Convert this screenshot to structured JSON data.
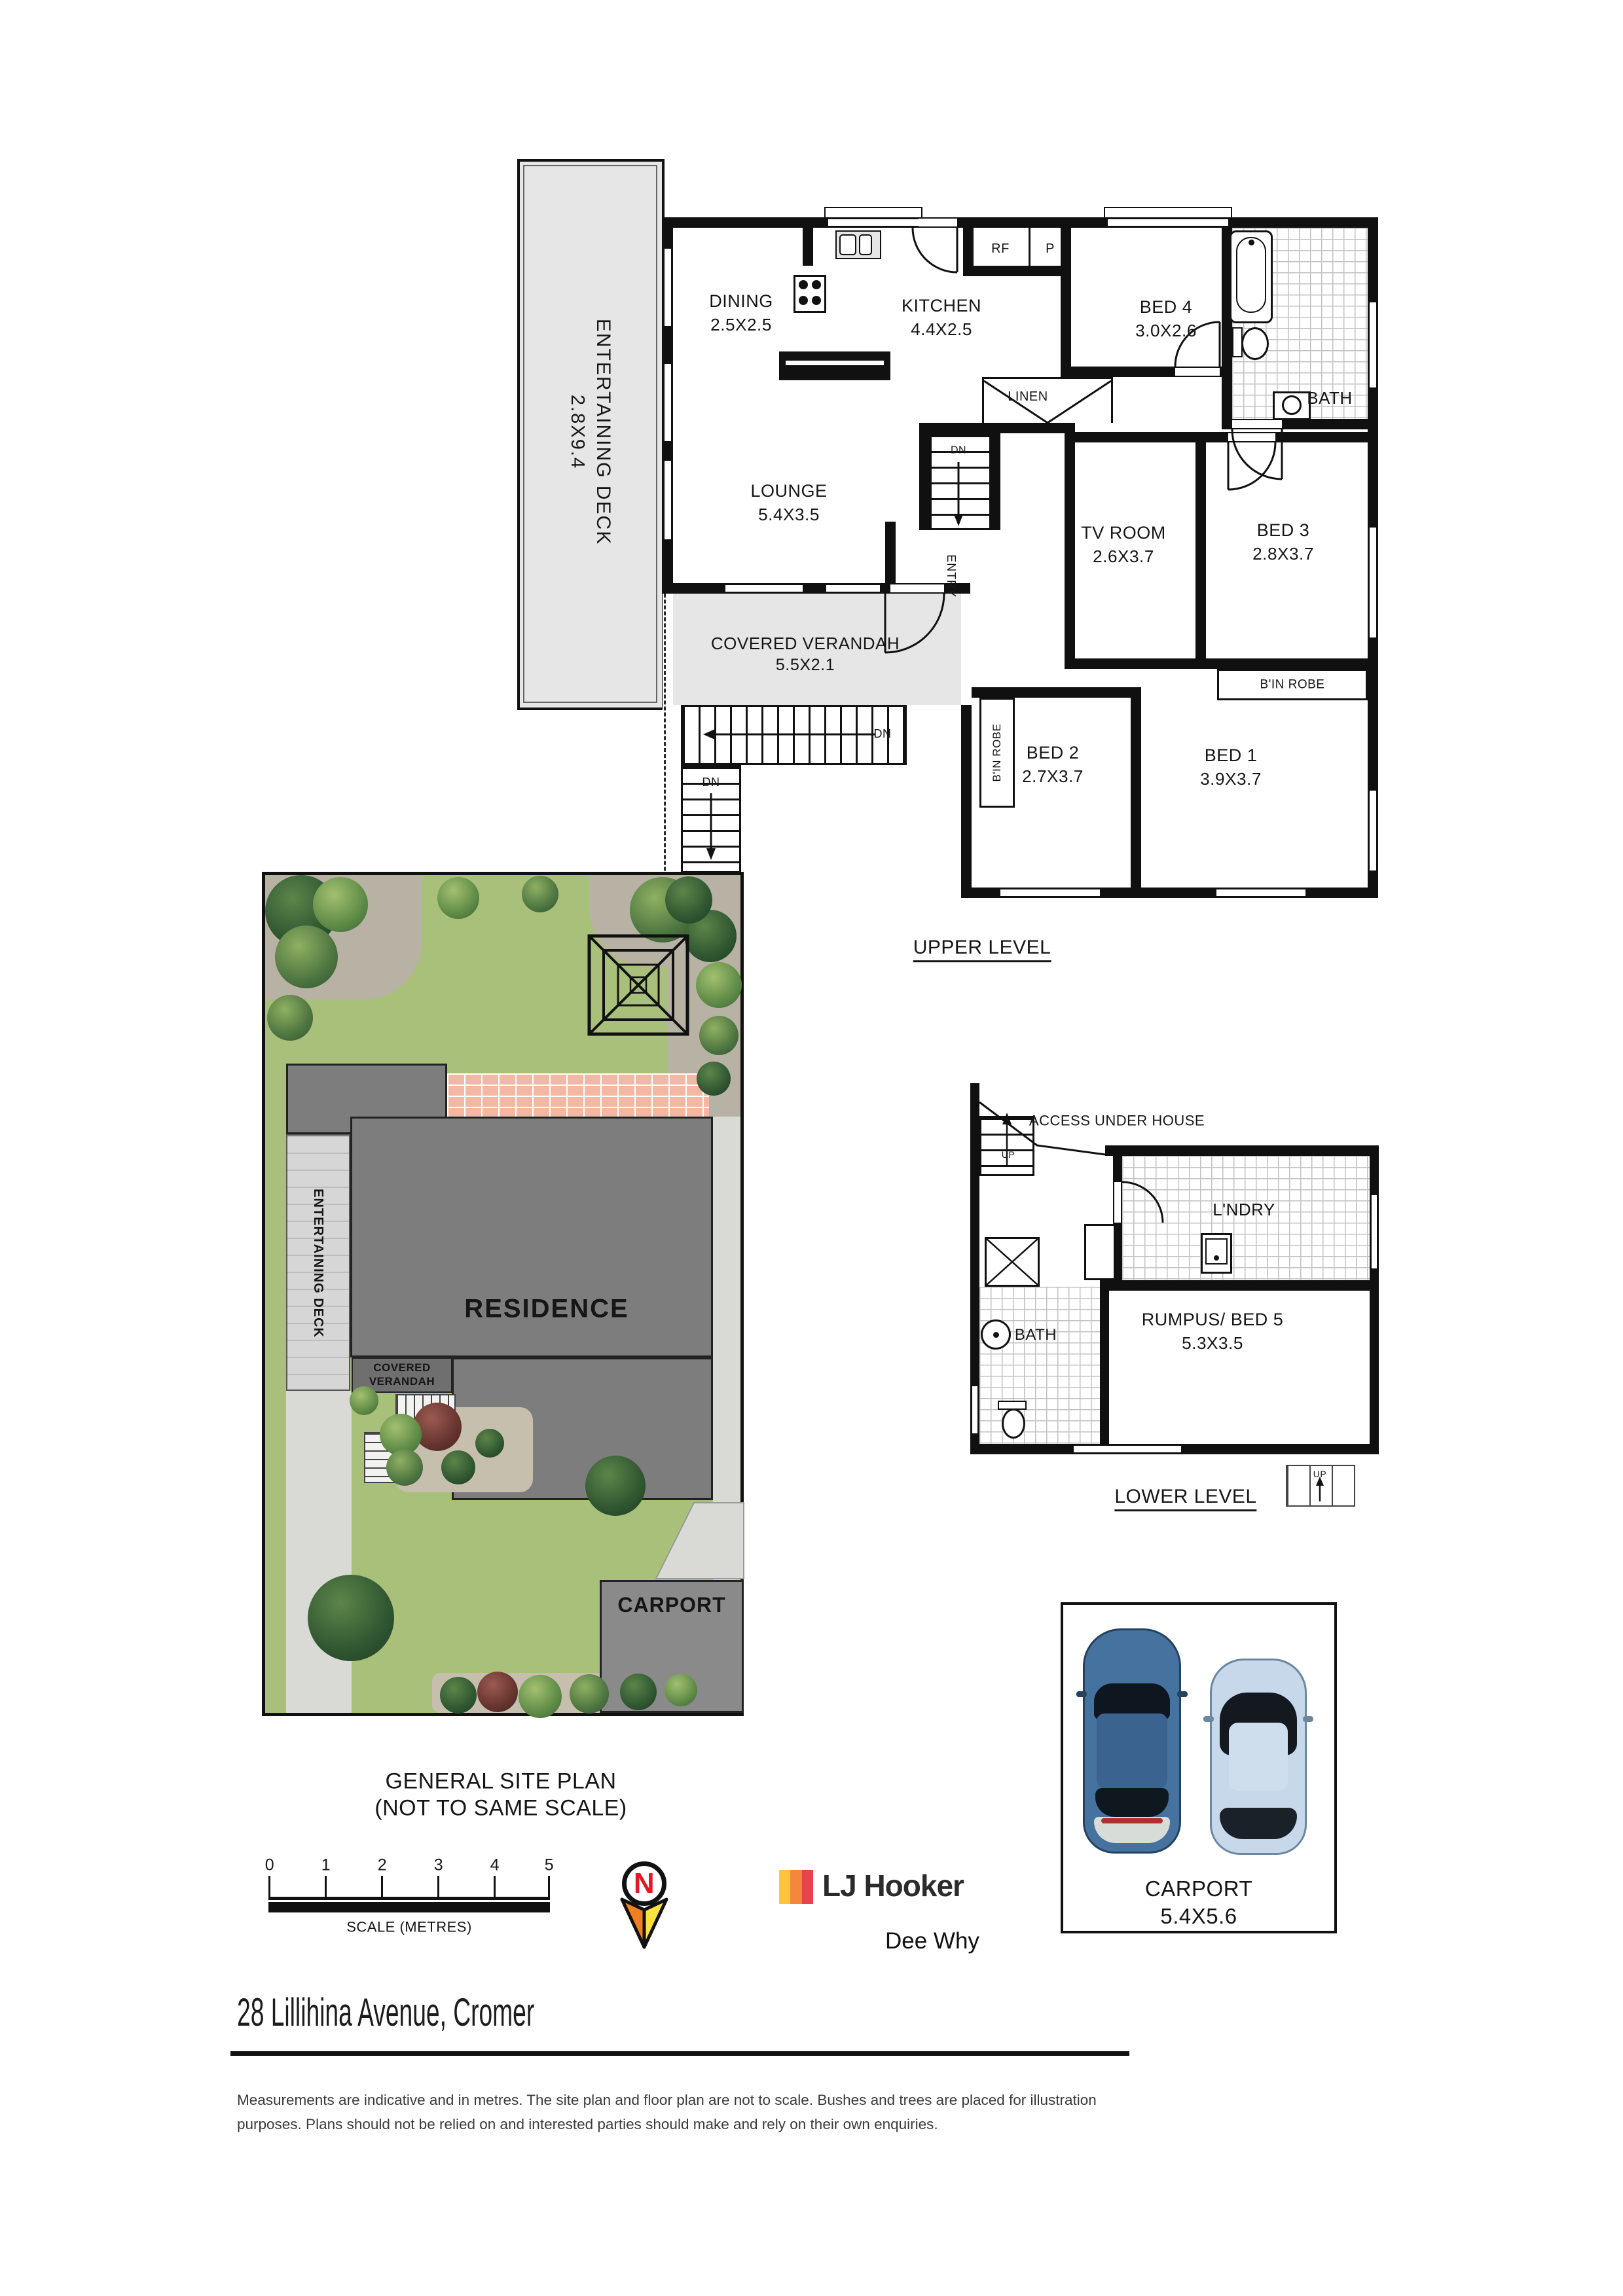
{
  "upper": {
    "title": "UPPER LEVEL",
    "deck": {
      "name": "ENTERTAINING DECK",
      "size": "2.8X9.4"
    },
    "dining": {
      "name": "DINING",
      "size": "2.5X2.5"
    },
    "kitchen": {
      "name": "KITCHEN",
      "size": "4.4X2.5"
    },
    "lounge": {
      "name": "LOUNGE",
      "size": "5.4X3.5"
    },
    "verandah": {
      "name": "COVERED VERANDAH",
      "size": "5.5X2.1"
    },
    "bed4": {
      "name": "BED 4",
      "size": "3.0X2.6"
    },
    "bath": "BATH",
    "tv": {
      "name": "TV ROOM",
      "size": "2.6X3.7"
    },
    "bed3": {
      "name": "BED 3",
      "size": "2.8X3.7"
    },
    "bed2": {
      "name": "BED 2",
      "size": "2.7X3.7"
    },
    "bed1": {
      "name": "BED 1",
      "size": "3.9X3.7"
    },
    "rf": "RF",
    "p": "P",
    "linen": "LINEN",
    "entry": "ENTRY",
    "dn": "DN",
    "robe": "B'IN ROBE"
  },
  "lower": {
    "title": "LOWER LEVEL",
    "access": "ACCESS UNDER HOUSE",
    "laundry": "L'NDRY",
    "rumpus": {
      "name": "RUMPUS/ BED 5",
      "size": "5.3X3.5"
    },
    "bath": "BATH",
    "up": "UP"
  },
  "site": {
    "title_line1": "GENERAL SITE PLAN",
    "title_line2": "(NOT TO SAME SCALE)",
    "residence": "RESIDENCE",
    "deck": "ENTERTAINING DECK",
    "verandah": "COVERED VERANDAH",
    "carport": "CARPORT"
  },
  "carport_detail": {
    "name": "CARPORT",
    "size": "5.4X5.6"
  },
  "scale_bar": {
    "ticks": [
      "0",
      "1",
      "2",
      "3",
      "4",
      "5"
    ],
    "caption": "SCALE (METRES)"
  },
  "north": {
    "letter": "N"
  },
  "brand": {
    "name": "LJ Hooker",
    "office": "Dee Why",
    "colors": [
      "#fdc53e",
      "#f5873c",
      "#e8434b"
    ]
  },
  "footer": {
    "address": "28 Lillihina Avenue, Cromer",
    "disclaimer_line1": "Measurements are indicative and in metres. The site plan and floor plan are not to scale. Bushes and trees are placed for illustration",
    "disclaimer_line2": "purposes.  Plans should not be relied on and interested parties should make and rely on their own enquiries."
  }
}
